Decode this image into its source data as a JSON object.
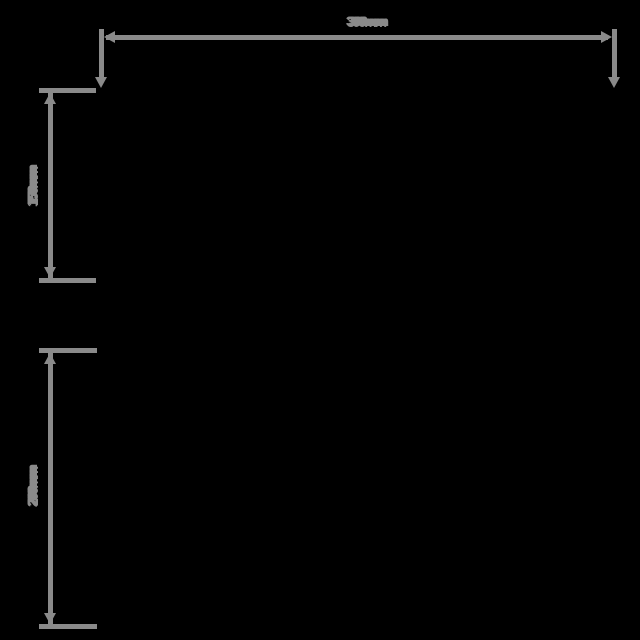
{
  "drawing": {
    "background_color": "#000000",
    "line_color": "#8a8a8a",
    "unit": "mm"
  },
  "dimensions": [
    {
      "id": "overall-width",
      "label": "300mm",
      "orientation": "horizontal"
    },
    {
      "id": "upper-height",
      "label": "150mm",
      "orientation": "vertical"
    },
    {
      "id": "lower-height",
      "label": "200mm",
      "orientation": "vertical"
    }
  ]
}
